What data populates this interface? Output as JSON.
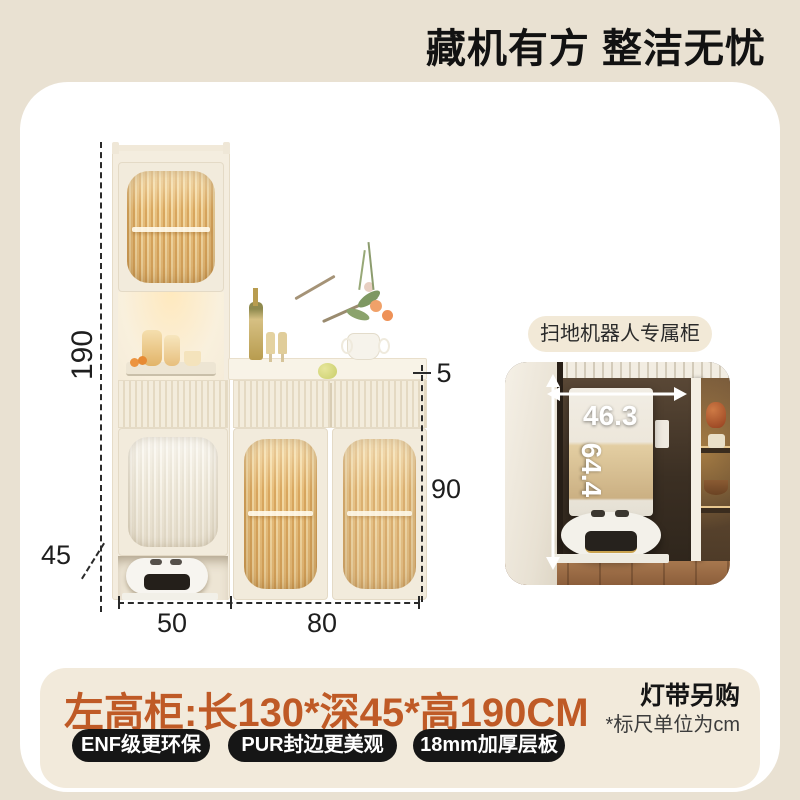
{
  "header": {
    "title": "藏机有方 整洁无忧"
  },
  "diagram": {
    "height_label": "190",
    "depth_label": "45",
    "width_left_label": "50",
    "width_right_label": "80",
    "top_thickness_label": "5",
    "body_height_label": "90"
  },
  "inset": {
    "caption": "扫地机器人专属柜",
    "niche_width": "46.3",
    "niche_height": "64.4"
  },
  "footer": {
    "spec": "左高柜:长130*深45*高190CM",
    "light_note": "灯带另购",
    "unit_note": "*标尺单位为cm",
    "badges": [
      "ENF级更环保",
      "PUR封边更美观",
      "18mm加厚层板"
    ]
  },
  "colors": {
    "page_bg": "#E9E1D2",
    "card_bg": "#FFFFFF",
    "panel_bg": "#F2EADB",
    "accent_orange": "#BF5A26",
    "badge_bg": "#161616",
    "pill_bg": "#F2E9D7",
    "glass_amber": "#E8C289",
    "dimension_line": "#2A2A2A"
  }
}
